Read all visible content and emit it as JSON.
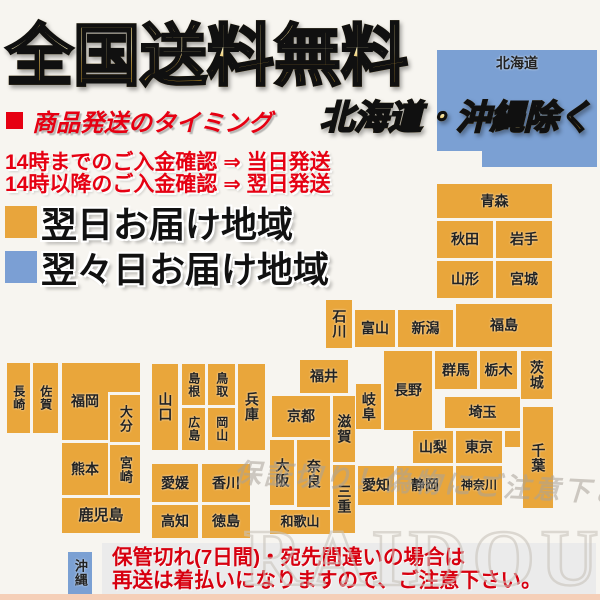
{
  "title": {
    "text": "全国送料無料"
  },
  "exclude_note": {
    "text": "北海道・沖縄除く"
  },
  "timing": {
    "heading": "商品発送のタイミング",
    "lines": [
      "14時までのご入金確認 ⇒ 当日発送",
      "14時以降のご入金確認 ⇒ 翌日発送"
    ]
  },
  "legend": [
    {
      "label": "翌日お届け地域",
      "color": "#e8a53c"
    },
    {
      "label": "翌々日お届け地域",
      "color": "#7b9fd4"
    }
  ],
  "notice": {
    "lines": [
      "保管切れ(7日間)・宛先間違いの場合は",
      "再送は着払いになりますので、ご注意下さい。"
    ]
  },
  "watermark": {
    "script_text": "保証切り！偽物にご注意下さい",
    "brand": "RAIDOU"
  },
  "colors": {
    "orange": "#e9a63b",
    "blue": "#7ba0d3",
    "red": "#e60012"
  },
  "map": {
    "tiles": [
      {
        "name": "hokkaido",
        "label": "北海道",
        "x": 437,
        "y": 50,
        "w": 160,
        "h": 101,
        "c": "b",
        "v": false,
        "vtop": true,
        "fs": 14
      },
      {
        "name": "hokkaido-tab",
        "label": "",
        "x": 482,
        "y": 150,
        "w": 115,
        "h": 17,
        "c": "b",
        "v": false
      },
      {
        "name": "aomori",
        "label": "青森",
        "x": 437,
        "y": 184,
        "w": 115,
        "h": 34,
        "c": "o",
        "v": false
      },
      {
        "name": "akita",
        "label": "秋田",
        "x": 437,
        "y": 221,
        "w": 56,
        "h": 37,
        "c": "o",
        "v": false
      },
      {
        "name": "iwate",
        "label": "岩手",
        "x": 496,
        "y": 221,
        "w": 56,
        "h": 37,
        "c": "o",
        "v": false
      },
      {
        "name": "yamagata",
        "label": "山形",
        "x": 437,
        "y": 261,
        "w": 56,
        "h": 37,
        "c": "o",
        "v": false
      },
      {
        "name": "miyagi",
        "label": "宮城",
        "x": 496,
        "y": 261,
        "w": 56,
        "h": 37,
        "c": "o",
        "v": false
      },
      {
        "name": "ishikawa",
        "label": "石川",
        "x": 326,
        "y": 300,
        "w": 26,
        "h": 48,
        "c": "o",
        "v": true
      },
      {
        "name": "toyama",
        "label": "富山",
        "x": 355,
        "y": 310,
        "w": 40,
        "h": 37,
        "c": "o",
        "v": false
      },
      {
        "name": "niigata",
        "label": "新潟",
        "x": 398,
        "y": 310,
        "w": 55,
        "h": 37,
        "c": "o",
        "v": false
      },
      {
        "name": "fukushima",
        "label": "福島",
        "x": 456,
        "y": 304,
        "w": 96,
        "h": 43,
        "c": "o",
        "v": false
      },
      {
        "name": "gunma",
        "label": "群馬",
        "x": 435,
        "y": 351,
        "w": 42,
        "h": 38,
        "c": "o",
        "v": false
      },
      {
        "name": "tochigi",
        "label": "栃木",
        "x": 480,
        "y": 351,
        "w": 37,
        "h": 38,
        "c": "o",
        "v": false
      },
      {
        "name": "ibaraki",
        "label": "茨城",
        "x": 521,
        "y": 351,
        "w": 31,
        "h": 48,
        "c": "o",
        "v": true
      },
      {
        "name": "nagano",
        "label": "長野",
        "x": 384,
        "y": 351,
        "w": 48,
        "h": 79,
        "c": "o",
        "v": false
      },
      {
        "name": "gifu",
        "label": "岐阜",
        "x": 356,
        "y": 384,
        "w": 25,
        "h": 45,
        "c": "o",
        "v": true
      },
      {
        "name": "saitama",
        "label": "埼玉",
        "x": 445,
        "y": 397,
        "w": 75,
        "h": 31,
        "c": "o",
        "v": false
      },
      {
        "name": "saitama-filler",
        "label": "",
        "x": 505,
        "y": 431,
        "w": 15,
        "h": 16,
        "c": "o",
        "v": false
      },
      {
        "name": "yamanashi",
        "label": "山梨",
        "x": 413,
        "y": 431,
        "w": 40,
        "h": 32,
        "c": "o",
        "v": false
      },
      {
        "name": "tokyo",
        "label": "東京",
        "x": 456,
        "y": 431,
        "w": 46,
        "h": 32,
        "c": "o",
        "v": false
      },
      {
        "name": "chiba",
        "label": "千葉",
        "x": 523,
        "y": 407,
        "w": 30,
        "h": 101,
        "c": "o",
        "v": true
      },
      {
        "name": "kanagawa",
        "label": "神奈川",
        "x": 456,
        "y": 466,
        "w": 46,
        "h": 39,
        "c": "o",
        "v": false,
        "fs": 12
      },
      {
        "name": "shizuoka",
        "label": "静岡",
        "x": 397,
        "y": 466,
        "w": 56,
        "h": 39,
        "c": "o",
        "v": false
      },
      {
        "name": "aichi",
        "label": "愛知",
        "x": 358,
        "y": 466,
        "w": 36,
        "h": 39,
        "c": "o",
        "v": false
      },
      {
        "name": "fukui",
        "label": "福井",
        "x": 300,
        "y": 360,
        "w": 48,
        "h": 33,
        "c": "o",
        "v": false
      },
      {
        "name": "shiga",
        "label": "滋賀",
        "x": 333,
        "y": 396,
        "w": 22,
        "h": 66,
        "c": "o",
        "v": true
      },
      {
        "name": "kyoto",
        "label": "京都",
        "x": 272,
        "y": 396,
        "w": 58,
        "h": 41,
        "c": "o",
        "v": false
      },
      {
        "name": "osaka",
        "label": "大阪",
        "x": 270,
        "y": 440,
        "w": 24,
        "h": 65,
        "c": "o",
        "v": true
      },
      {
        "name": "nara",
        "label": "奈良",
        "x": 297,
        "y": 440,
        "w": 33,
        "h": 67,
        "c": "o",
        "v": true
      },
      {
        "name": "mie",
        "label": "三重",
        "x": 333,
        "y": 465,
        "w": 22,
        "h": 68,
        "c": "o",
        "v": true
      },
      {
        "name": "wakayama",
        "label": "和歌山",
        "x": 270,
        "y": 510,
        "w": 60,
        "h": 24,
        "c": "o",
        "v": false,
        "fs": 13
      },
      {
        "name": "hyogo",
        "label": "兵庫",
        "x": 238,
        "y": 364,
        "w": 27,
        "h": 86,
        "c": "o",
        "v": true
      },
      {
        "name": "yamaguchi",
        "label": "山口",
        "x": 152,
        "y": 364,
        "w": 26,
        "h": 86,
        "c": "o",
        "v": true
      },
      {
        "name": "shimane",
        "label": "島根",
        "x": 182,
        "y": 364,
        "w": 23,
        "h": 41,
        "c": "o",
        "v": true,
        "fs": 12
      },
      {
        "name": "tottori",
        "label": "鳥取",
        "x": 208,
        "y": 364,
        "w": 27,
        "h": 41,
        "c": "o",
        "v": true,
        "fs": 12
      },
      {
        "name": "hiroshima",
        "label": "広島",
        "x": 182,
        "y": 408,
        "w": 23,
        "h": 42,
        "c": "o",
        "v": true,
        "fs": 12
      },
      {
        "name": "okayama",
        "label": "岡山",
        "x": 208,
        "y": 408,
        "w": 27,
        "h": 42,
        "c": "o",
        "v": true,
        "fs": 12
      },
      {
        "name": "ehime",
        "label": "愛媛",
        "x": 152,
        "y": 464,
        "w": 46,
        "h": 38,
        "c": "o",
        "v": false
      },
      {
        "name": "kagawa",
        "label": "香川",
        "x": 202,
        "y": 464,
        "w": 48,
        "h": 38,
        "c": "o",
        "v": false
      },
      {
        "name": "kochi",
        "label": "高知",
        "x": 152,
        "y": 505,
        "w": 46,
        "h": 33,
        "c": "o",
        "v": false
      },
      {
        "name": "tokushima",
        "label": "徳島",
        "x": 202,
        "y": 505,
        "w": 48,
        "h": 33,
        "c": "o",
        "v": false
      },
      {
        "name": "nagasaki",
        "label": "長崎",
        "x": 7,
        "y": 363,
        "w": 23,
        "h": 70,
        "c": "o",
        "v": true,
        "fs": 12
      },
      {
        "name": "saga",
        "label": "佐賀",
        "x": 33,
        "y": 363,
        "w": 25,
        "h": 70,
        "c": "o",
        "v": true,
        "fs": 12
      },
      {
        "name": "fukuoka",
        "label": "福岡",
        "x": 62,
        "y": 363,
        "w": 46,
        "h": 77,
        "c": "o",
        "v": false
      },
      {
        "name": "fukuoka-ext",
        "label": "",
        "x": 108,
        "y": 363,
        "w": 32,
        "h": 29,
        "c": "o",
        "v": false
      },
      {
        "name": "oita",
        "label": "大分",
        "x": 110,
        "y": 395,
        "w": 30,
        "h": 47,
        "c": "o",
        "v": true,
        "fs": 13
      },
      {
        "name": "kumamoto",
        "label": "熊本",
        "x": 62,
        "y": 443,
        "w": 46,
        "h": 52,
        "c": "o",
        "v": false
      },
      {
        "name": "miyazaki",
        "label": "宮崎",
        "x": 110,
        "y": 445,
        "w": 30,
        "h": 50,
        "c": "o",
        "v": true,
        "fs": 13
      },
      {
        "name": "kagoshima",
        "label": "鹿児島",
        "x": 62,
        "y": 498,
        "w": 78,
        "h": 35,
        "c": "o",
        "v": false,
        "fs": 15
      },
      {
        "name": "okinawa",
        "label": "沖縄",
        "x": 68,
        "y": 552,
        "w": 24,
        "h": 42,
        "c": "b",
        "v": true,
        "fs": 13
      }
    ]
  }
}
